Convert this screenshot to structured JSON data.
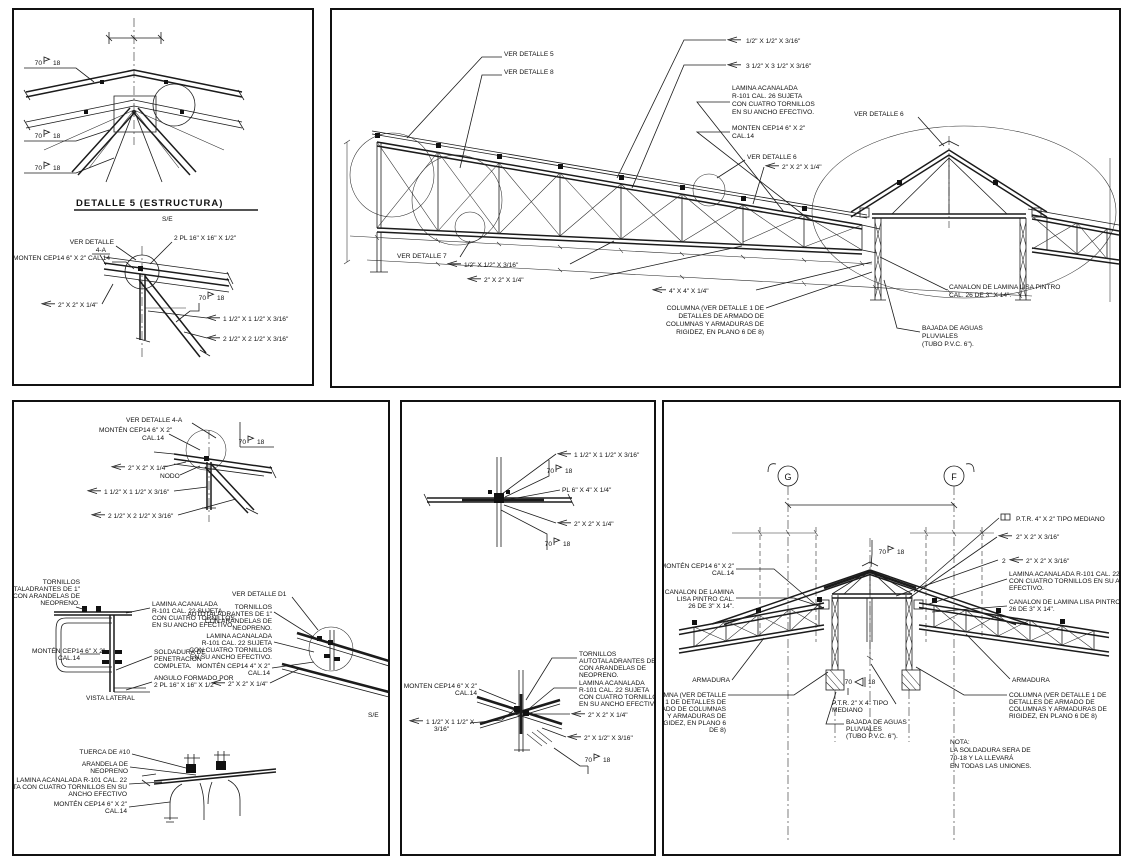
{
  "sheet": {
    "background": "#ffffff",
    "line_color": "#1b1b1b"
  },
  "weld": {
    "a": "70",
    "b": "18",
    "full": "70-18"
  },
  "p1": {
    "title": "DETALLE 5 (ESTRUCTURA)",
    "scale": "S/E",
    "ver_detalle_line1": "VER DETALLE",
    "ver_detalle_line2": "4-A",
    "monten": "MONTEN CEP14 6\" X 2\" CAL.14",
    "plates": "2 PL 16\" X 16\" X 1/2\"",
    "angle_a": "2\" X 2\" X 1/4\"",
    "angle_b": "1 1/2\" X 1 1/2\" X 3/16\"",
    "angle_c": "2 1/2\" X 2 1/2\" X 3/16\""
  },
  "p2": {
    "ver_detalle_5": "VER DETALLE 5",
    "ver_detalle_8": "VER DETALLE 8",
    "bar_a": "1/2\" X 1/2\" X 3/16\"",
    "angle_big": "3 1/2\" X 3 1/2\" X 3/16\"",
    "lamina": [
      "LAMINA ACANALADA",
      "R-101 CAL. 26 SUJETA",
      "CON CUATRO TORNILLOS",
      "EN SU ANCHO EFECTIVO."
    ],
    "monten": [
      "MONTEN CEP14 6\" X 2\"",
      "CAL.14"
    ],
    "ver_detalle_6a": "VER DETALLE 6",
    "angle_a": "2\" X 2\" X 1/4\"",
    "ver_detalle_6b": "VER DETALLE 6",
    "ver_detalle_7": "VER DETALLE 7",
    "bar_b": "1/2\" X 1/2\" X 3/16\"",
    "angle_b": "2\" X 2\" X 1/4\"",
    "angle_c": "4\" X 4\" X 1/4\"",
    "columna": [
      "COLUMNA (VER DETALLE 1 DE",
      "DETALLES DE ARMADO DE",
      "COLUMNAS Y ARMADURAS DE",
      "RIGIDEZ, EN PLANO 6 DE 8)"
    ],
    "canalon": [
      "CANALON DE LAMINA LISA PINTRO",
      "CAL. 26 DE 3\" X 14\"."
    ],
    "bajada": [
      "BAJADA DE AGUAS",
      "PLUVIALES",
      "(TUBO P.V.C. 6\")."
    ]
  },
  "p3": {
    "ver_detalle_4a": "VER DETALLE 4-A",
    "monten_top": [
      "MONTÉN CEP14 6\" X 2\"",
      "CAL.14"
    ],
    "angle_a": "2\" X 2\" X 1/4\"",
    "nodo": "NODO",
    "angle_b": "1 1/2\" X 1 1/2\" X 3/16\"",
    "angle_c": "2 1/2\" X 2 1/2\" X 3/16\"",
    "tornillos": [
      "TORNILLOS",
      "AUTOTALADRANTES DE 1\"",
      "CON ARANDELAS DE",
      "NEOPRENO."
    ],
    "lamina": [
      "LAMINA ACANALADA",
      "R-101 CAL. 22 SUJETA",
      "CON CUATRO TORNILLOS",
      "EN SU ANCHO EFECTIVO."
    ],
    "monten_lat": [
      "MONTÉN CEP14 6\" X 2\"",
      "CAL.14"
    ],
    "soldadura": [
      "SOLDADURA DE",
      "PENETRACION",
      "COMPLETA."
    ],
    "angulo": [
      "ANGULO FORMADO POR",
      "2 PL 16\" X 16\" X 1/2\""
    ],
    "vista_lateral": "VISTA LATERAL",
    "ver_detalle_d1": "VER DETALLE D1",
    "tornillos_d1": [
      "TORNILLOS",
      "AUTOTALADRANTES DE 1\"",
      "CON ARANDELAS DE",
      "NEOPRENO."
    ],
    "lamina_d1": [
      "LAMINA ACANALADA",
      "R-101 CAL. 22 SUJETA",
      "CON CUATRO TORNILLOS",
      "EN SU ANCHO EFECTIVO."
    ],
    "monten_d1": [
      "MONTÉN CEP14 4\" X 2\"",
      "CAL.14"
    ],
    "angle_d": "2\" X 2\" X 1/4\"",
    "scale": "S/E",
    "tuerca": "TUERCA DE #10",
    "arandela": [
      "ARANDELA DE",
      "NEOPRENO"
    ],
    "lamina_b": [
      "LAMINA ACANALADA R-101 CAL. 22",
      "SUJETA CON CUATRO TORNILLOS EN SU",
      "ANCHO EFECTIVO"
    ],
    "monten_b": [
      "MONTÉN CEP14 6\" X 2\"",
      "CAL.14"
    ]
  },
  "p4": {
    "angle_a": "1 1/2\" X 1 1/2\" X 3/16\"",
    "plate": "PL 6\" X 4\" X 1/4\"",
    "angle_b": "2\" X 2\" X 1/4\"",
    "tornillos": [
      "TORNILLOS",
      "AUTOTALADRANTES DE 1\"",
      "CON ARANDELAS DE",
      "NEOPRENO."
    ],
    "lamina": [
      "LAMINA ACANALADA",
      "R-101 CAL. 22 SUJETA",
      "CON CUATRO TORNILLOS",
      "EN SU ANCHO EFECTIVO."
    ],
    "monten": [
      "MONTEN CEP14 6\" X 2\"",
      "CAL.14"
    ],
    "angle_c": "2\" X 2\" X 1/4\"",
    "angle_d": [
      "1 1/2\" X 1 1/2\" X",
      "3/16\""
    ],
    "angle_e": "2\" X 1/2\" X 3/16\""
  },
  "p5": {
    "grid_g": "G",
    "grid_f": "F",
    "ptr_a": "P.T.R. 4\" X 2\" TIPO MEDIANO",
    "angle_a": "2\" X 2\" X 3/16\"",
    "qty2": "2",
    "angle_b": "2\" X 2\" X 3/16\"",
    "lamina": [
      "LAMINA ACANALADA R-101 CAL. 22 SUJETA",
      "CON CUATRO TORNILLOS EN SU ANCHO",
      "EFECTIVO."
    ],
    "canalon_r": [
      "CANALON DE LAMINA LISA PINTRO  CAL.",
      "26 DE 3\" X 14\"."
    ],
    "monten": [
      "MONTÉN CEP14 6\" X 2\"",
      "CAL.14"
    ],
    "canalon_l": [
      "CANALON DE LAMINA",
      "LISA PINTRO  CAL.",
      "26 DE 3\" X 14\"."
    ],
    "armadura_l": "ARMADURA",
    "armadura_r": "ARMADURA",
    "columna_l": [
      "COLUMNA (VER DETALLE",
      "1 DE DETALLES DE",
      "ARMADO DE COLUMNAS",
      "Y ARMADURAS DE",
      "RIGIDEZ, EN PLANO 6",
      "DE 8)"
    ],
    "columna_r": [
      "COLUMNA (VER DETALLE 1 DE",
      "DETALLES DE ARMADO DE",
      "COLUMNAS Y ARMADURAS DE",
      "RIGIDEZ, EN PLANO 6 DE 8)"
    ],
    "ptr_b": [
      "P.T.R. 2\" X 4\" TIPO",
      "MEDIANO"
    ],
    "bajada": [
      "BAJADA DE AGUAS",
      "PLUVIALES",
      "(TUBO P.V.C. 6\")."
    ],
    "nota": [
      "NOTA:",
      "LA SOLDADURA SERA DE",
      "70-18 Y LA  LLEVARÁ",
      "EN TODAS LAS UNIONES."
    ]
  }
}
